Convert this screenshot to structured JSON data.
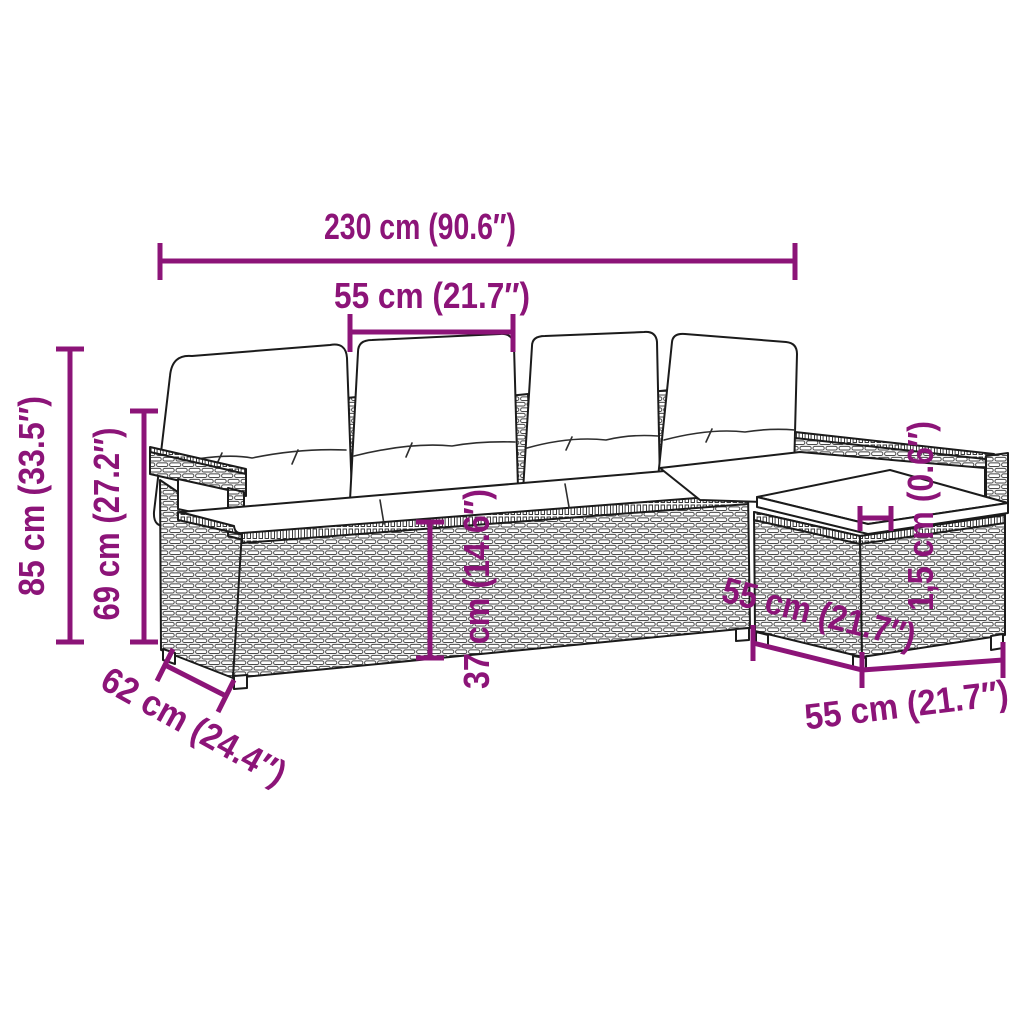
{
  "colors": {
    "accent": "#8C1478",
    "line_art": "#1B1B1B",
    "background": "#FFFFFF"
  },
  "dimensions": {
    "overall_width": "230 cm (90.6″)",
    "seat_width": "55 cm (21.7″)",
    "overall_height": "85 cm (33.5″)",
    "backrest_height": "69 cm (27.2″)",
    "seat_base_height": "37 cm (14.6″)",
    "cushion_thickness": "1,5 cm (0.6″)",
    "overall_depth": "62 cm (24.4″)",
    "stool_side_depth": "55 cm (21.7″)",
    "stool_front_width": "55 cm (21.7″)"
  }
}
